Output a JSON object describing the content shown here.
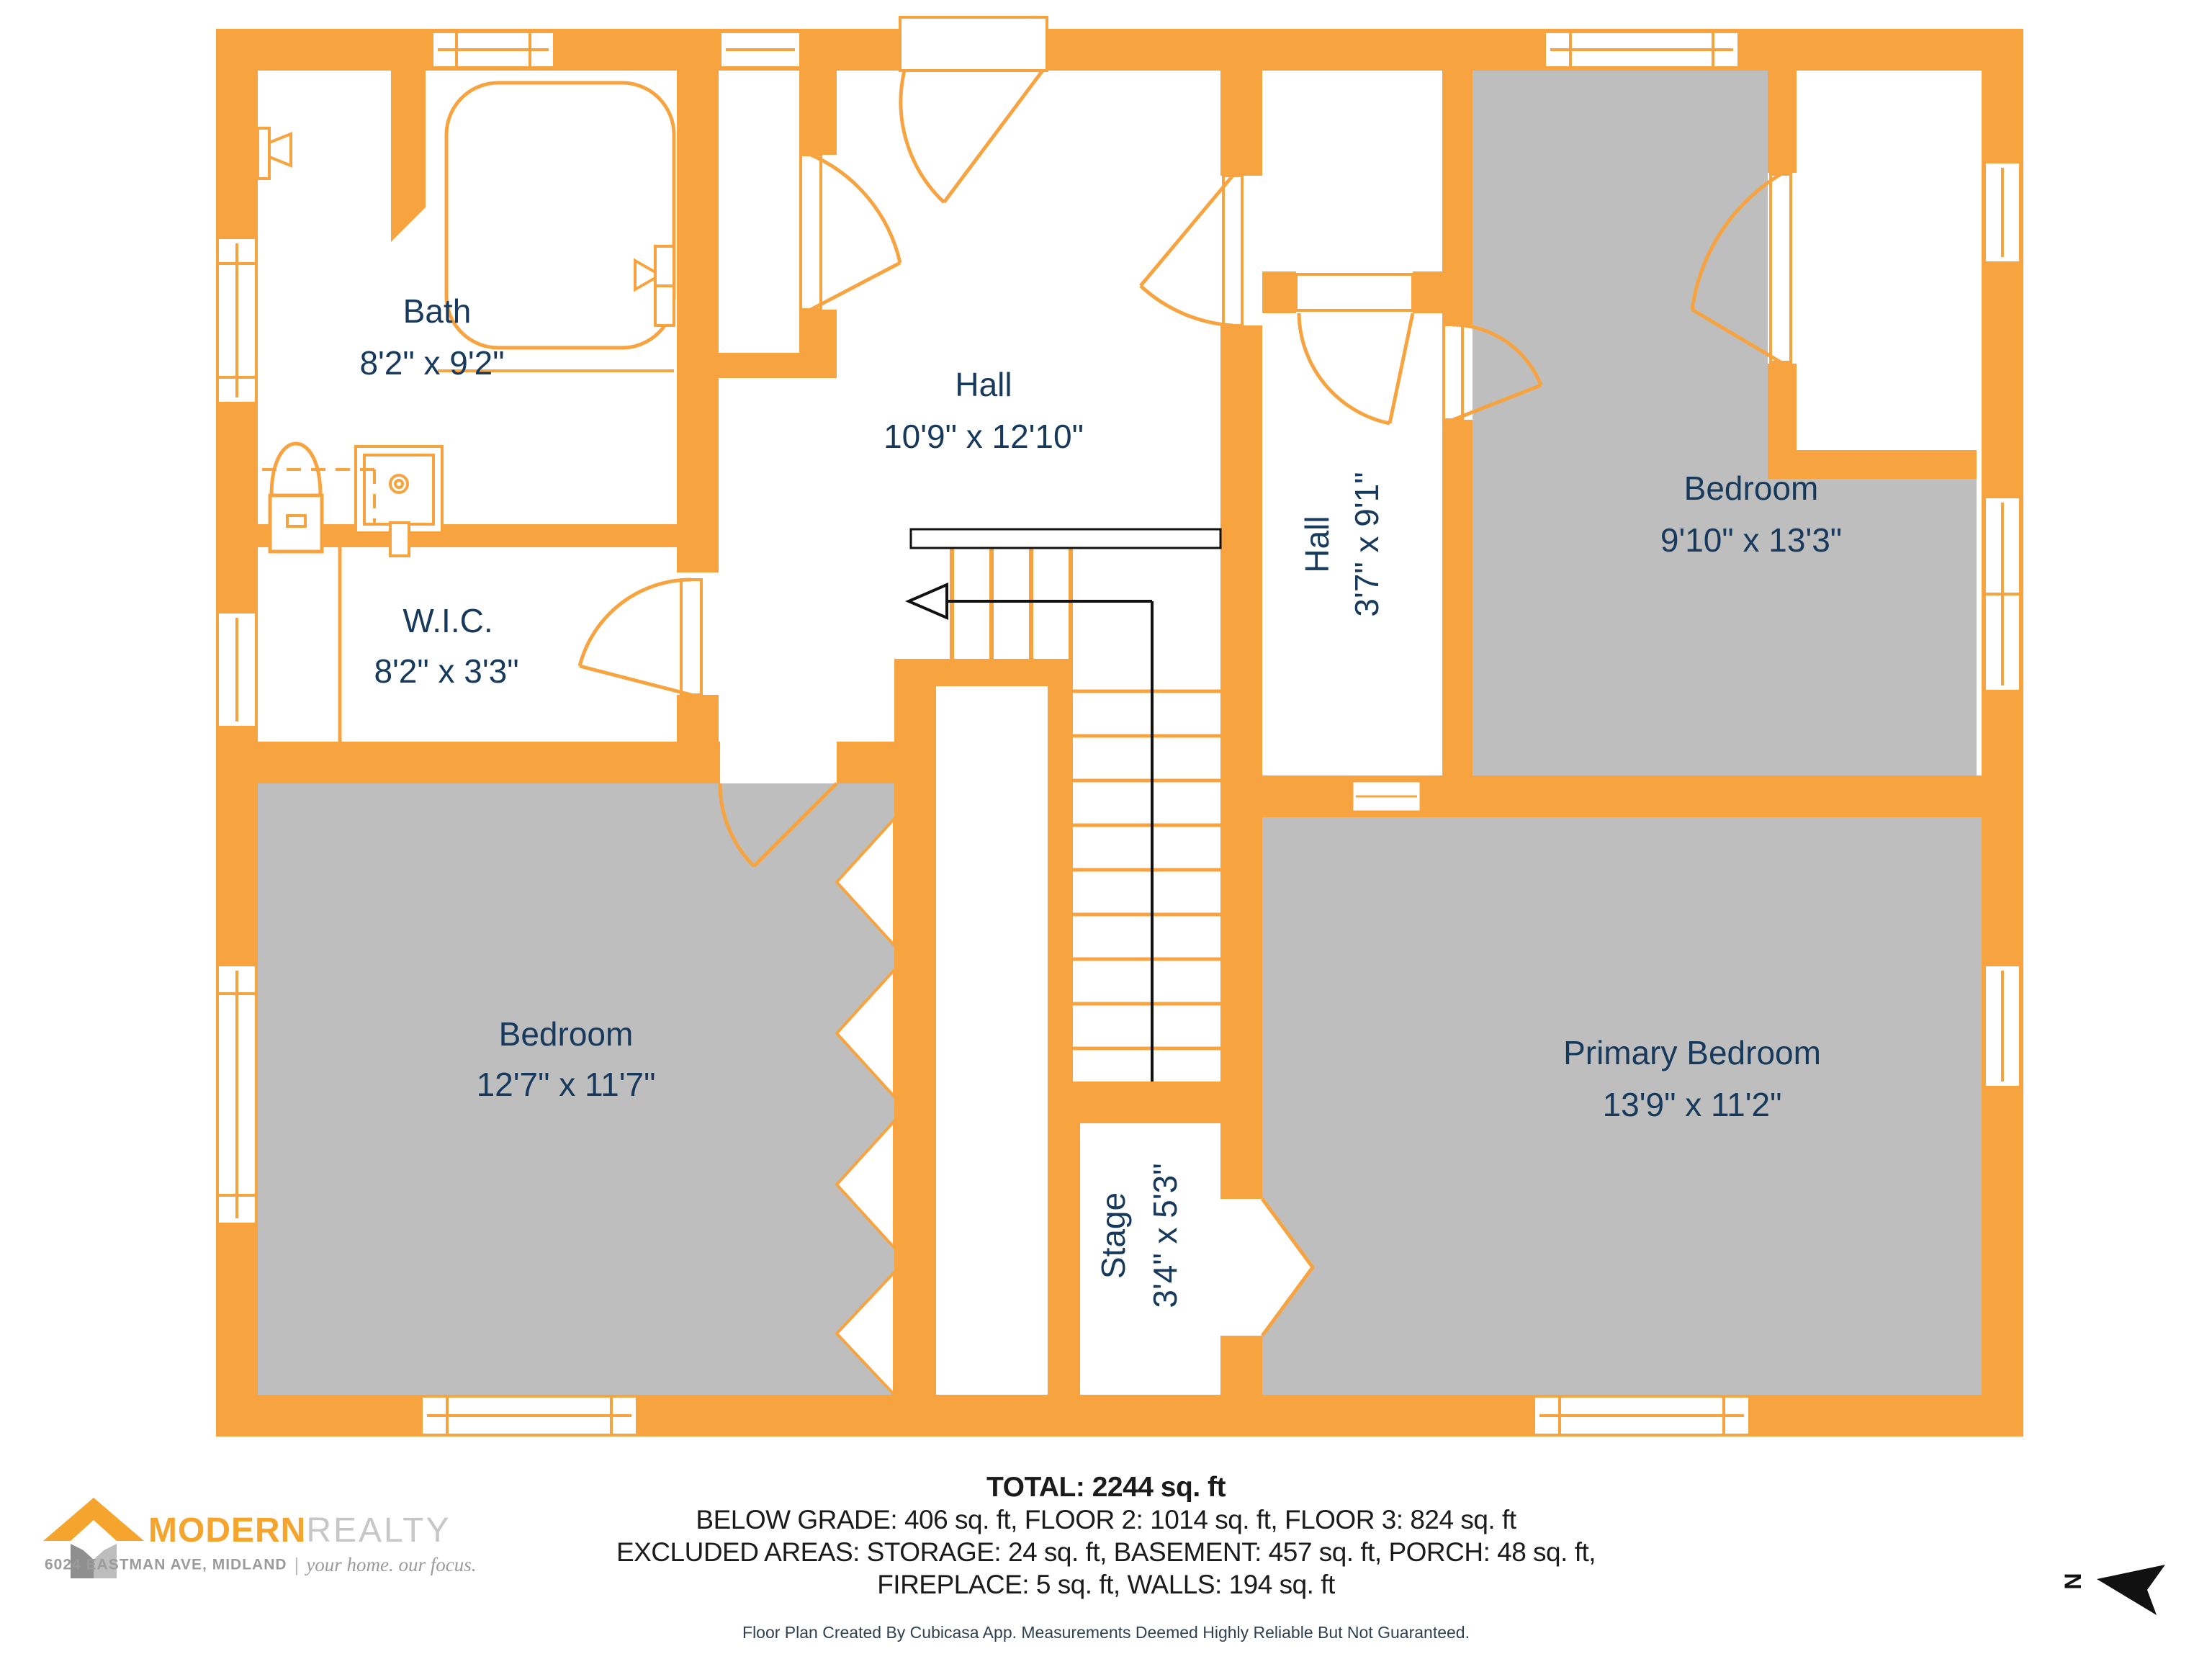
{
  "plan": {
    "rooms": {
      "bath": {
        "name": "Bath",
        "dims": "8'2\" x 9'2\""
      },
      "wic": {
        "name": "W.I.C.",
        "dims": "8'2\" x 3'3\""
      },
      "hall": {
        "name": "Hall",
        "dims": "10'9\" x 12'10\""
      },
      "hall_small": {
        "name": "Hall",
        "dims": "3'7\" x 9'1\""
      },
      "bedroom_right": {
        "name": "Bedroom",
        "dims": "9'10\" x 13'3\""
      },
      "bedroom_left": {
        "name": "Bedroom",
        "dims": "12'7\" x 11'7\""
      },
      "primary": {
        "name": "Primary Bedroom",
        "dims": "13'9\" x 11'2\""
      },
      "stage": {
        "name": "Stage",
        "dims": "3'4\" x 5'3\""
      }
    },
    "north_label": "N"
  },
  "summary": {
    "total": "TOTAL: 2244 sq. ft",
    "line2": "BELOW GRADE: 406 sq. ft, FLOOR 2: 1014 sq. ft, FLOOR 3: 824 sq. ft",
    "line3": "EXCLUDED AREAS: STORAGE: 24 sq. ft, BASEMENT: 457 sq. ft, PORCH: 48 sq. ft,",
    "line4": "FIREPLACE: 5 sq. ft, WALLS: 194 sq. ft",
    "disclaimer": "Floor Plan Created By Cubicasa App. Measurements Deemed Highly Reliable But Not Guaranteed."
  },
  "logo": {
    "brand_primary": "MODERN",
    "brand_secondary": "REALTY",
    "address": "6024 EASTMAN AVE, MIDLAND",
    "separator": "|",
    "tagline": "your home. our focus."
  },
  "colors": {
    "wall_orange": "#F7A440",
    "room_gray": "#BEBEBE",
    "label_navy": "#17395C"
  }
}
